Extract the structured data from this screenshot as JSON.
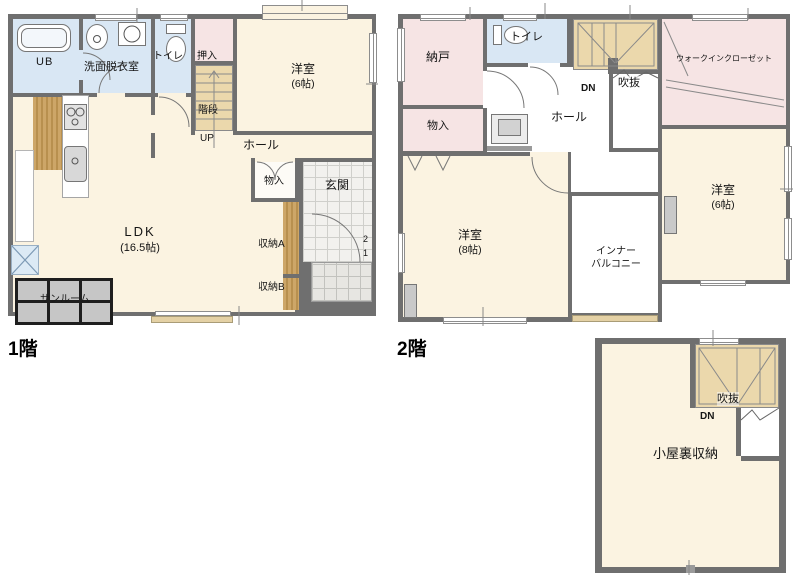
{
  "floor1": {
    "title": "1階",
    "ub": "UB",
    "senmen": "洗面脱衣室",
    "toilet": "トイレ",
    "oshiire": "押入",
    "kaidan": "階段",
    "up": "UP",
    "yoshitsu": "洋室",
    "yoshitsu_size": "(6帖)",
    "hall": "ホール",
    "ldk": "LDK",
    "ldk_size": "(16.5帖)",
    "monoire": "物入",
    "genkan": "玄関",
    "shuno_a": "収納A",
    "shuno_b": "収納B",
    "sunroom": "サンルーム",
    "step2": "2",
    "step1": "1"
  },
  "floor2": {
    "title": "2階",
    "nando": "納戸",
    "toilet": "トイレ",
    "monoire": "物入",
    "hall": "ホール",
    "dn": "DN",
    "fukinuke": "吹抜",
    "wic": "ウォークインクローゼット",
    "yoshitsu8": "洋室",
    "yoshitsu8_size": "(8帖)",
    "yoshitsu6": "洋室",
    "yoshitsu6_size": "(6帖)",
    "balcony1": "インナー",
    "balcony2": "バルコニー"
  },
  "attic": {
    "koyaura": "小屋裏収納",
    "dn": "DN",
    "fukinuke": "吹抜"
  },
  "colors": {
    "wall": "#6f6f6f",
    "room_cream": "#fbf3e1",
    "wet_blue": "#d9e7f4",
    "closet_pink": "#f6e4e4",
    "stairs_tan": "#ebd8ac",
    "wood": "#c9a166",
    "sunroom_gray": "#c6c6c6",
    "genkan_tile": "#f2f1ee",
    "porch_tile": "#e7e6e2",
    "rail_tan": "#e4d1a5",
    "accent_blue": "#dceaf5"
  }
}
